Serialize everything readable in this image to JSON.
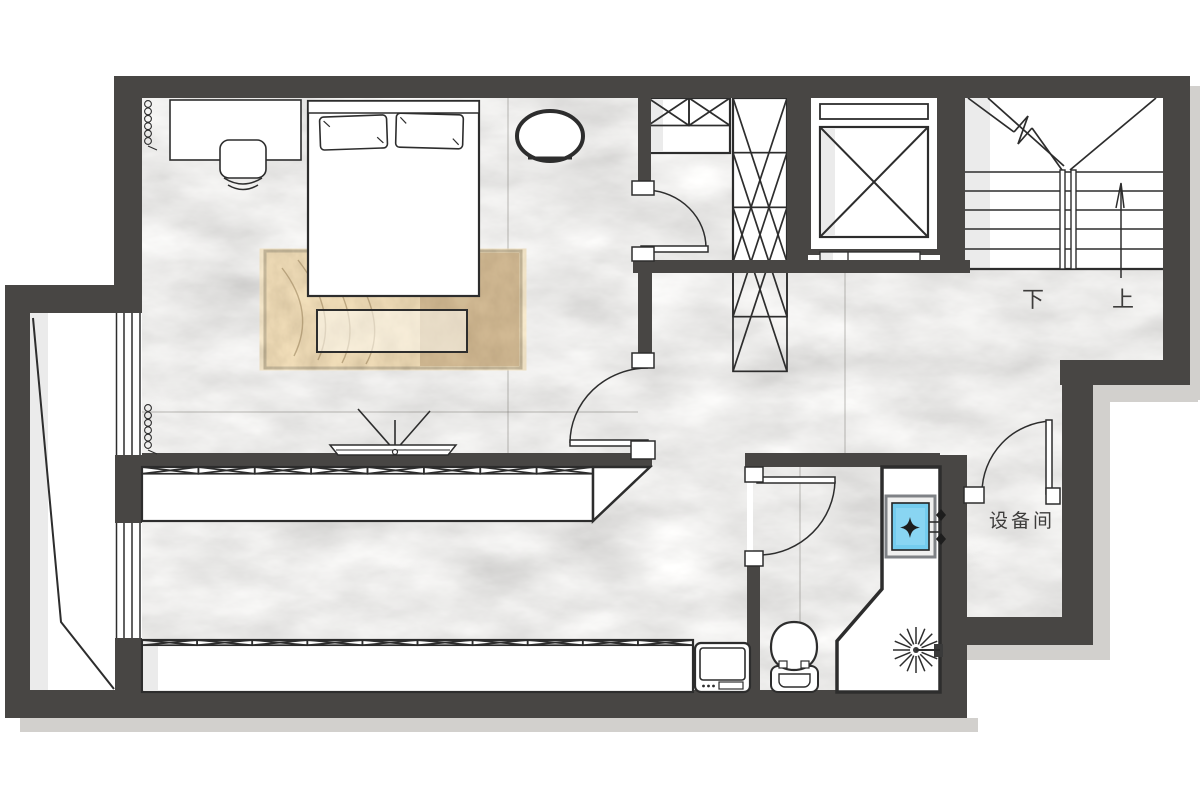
{
  "labels": {
    "stair_down": "下",
    "stair_up": "上",
    "equipment_room": "设备间"
  },
  "palette": {
    "wall": "#484644",
    "line": "#2d2d2d",
    "floor_base": "#d8d5d2",
    "shadow": "#d2d0cd",
    "rug": "#c9b394",
    "rug_dark": "#9d7f58",
    "sink_blue": "#74ccee",
    "paper": "#ffffff"
  },
  "symbols": {
    "bed": "double-bed",
    "desk": "desk",
    "stool": "desk-stool",
    "pouf": "oval-pouf",
    "rug": "area-rug",
    "bench": "bed-end-bench",
    "tv": "wall-tv",
    "wardrobe": "x-hatched-wardrobe",
    "closet": "x-hatched-closet",
    "elevator": "elevator-shaft",
    "stairs": "u-return-stairs",
    "toilet": "toilet",
    "basin": "blue-washbasin",
    "shower": "shower-spray",
    "washer": "washing-machine",
    "radiator": "coil-symbol",
    "window": "triple-line-window",
    "door": "swing-door"
  }
}
